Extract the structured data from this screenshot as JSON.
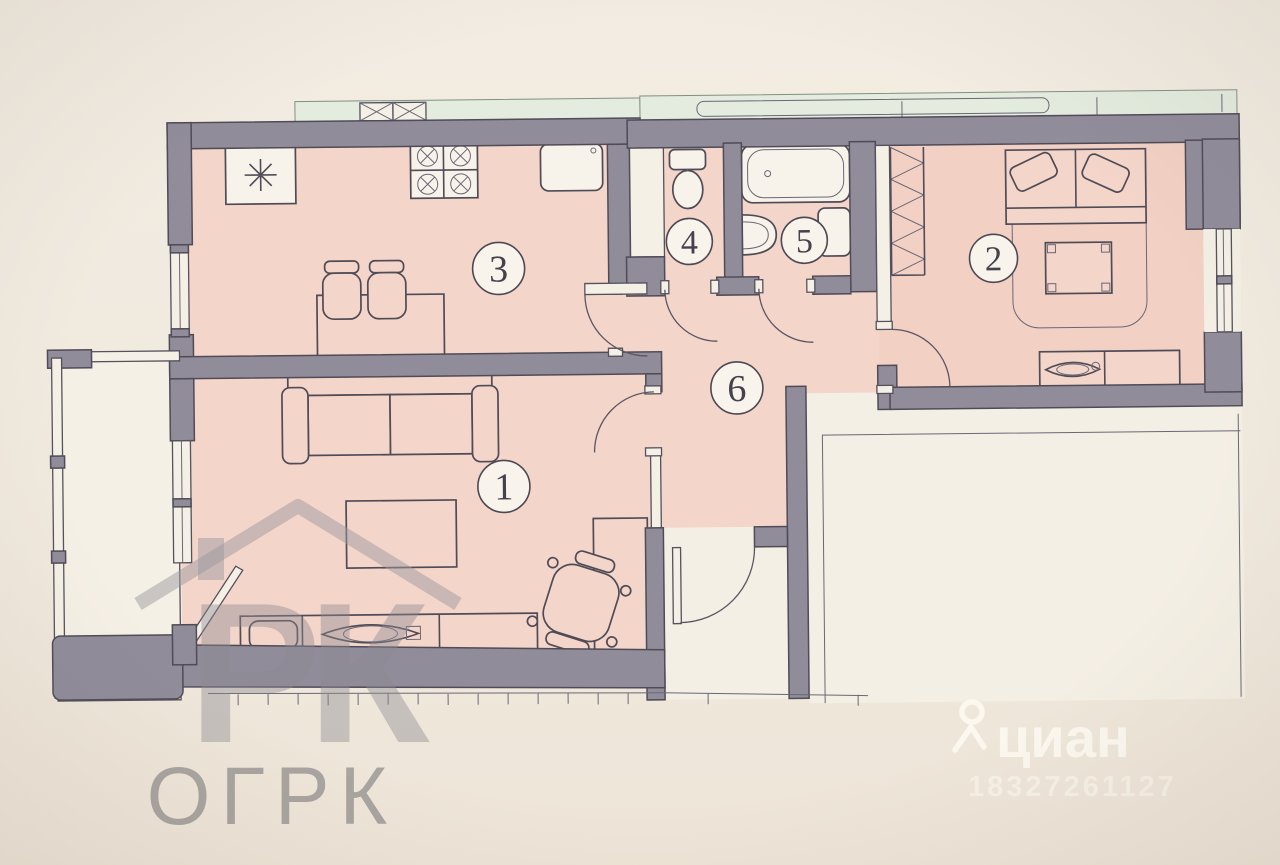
{
  "plan": {
    "rooms": [
      {
        "n": "1",
        "kind": "living-room"
      },
      {
        "n": "2",
        "kind": "bedroom"
      },
      {
        "n": "3",
        "kind": "kitchen"
      },
      {
        "n": "4",
        "kind": "wc"
      },
      {
        "n": "5",
        "kind": "bathroom"
      },
      {
        "n": "6",
        "kind": "hallway"
      }
    ]
  },
  "watermarks": {
    "ogrk_logo_letters": "РК",
    "ogrk": "ОГРК",
    "cian": "циан",
    "cian_id": "18327261127"
  },
  "colors": {
    "wall": "#908c9a",
    "floor_pink": "#f4d5c9",
    "balcony_white": "#f4efe4",
    "facade_green": "#e3ecdf",
    "paper": "#f0e9de"
  }
}
